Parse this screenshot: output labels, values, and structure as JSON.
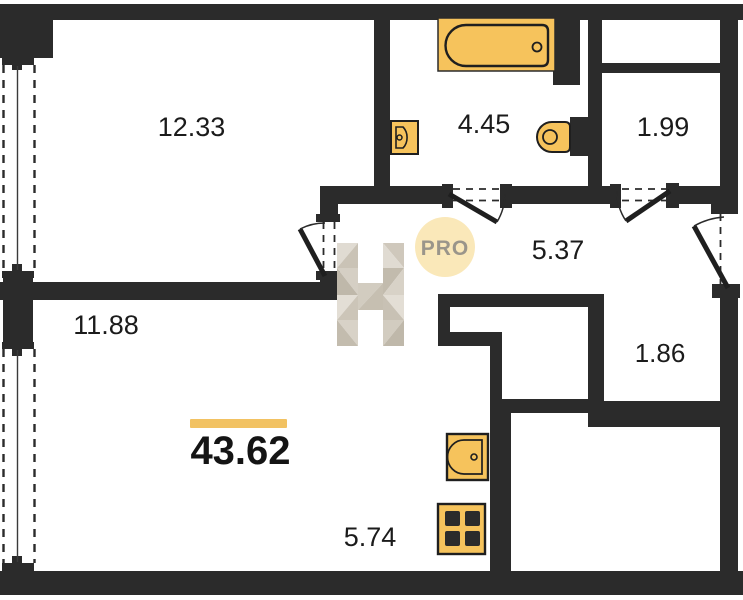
{
  "floorplan": {
    "total_area": "43.62",
    "rooms": [
      {
        "area": "12.33"
      },
      {
        "area": "4.45"
      },
      {
        "area": "1.99"
      },
      {
        "area": "5.37"
      },
      {
        "area": "1.86"
      },
      {
        "area": "11.88"
      },
      {
        "area": "5.74"
      }
    ],
    "watermark": {
      "pro": "PRO",
      "letter": "H"
    },
    "fixtures": [
      "bathtub-icon",
      "bath-sink-icon",
      "toilet-icon",
      "kitchen-sink-icon",
      "stove-icon"
    ],
    "colors": {
      "wall": "#2b2b2b",
      "fixture_fill": "#f6c35c",
      "fixture_outline": "#1f1f1f",
      "accent_bar": "#f2c262",
      "pro_circle": "#fae8b9",
      "pro_text": "#9a958a",
      "label_text": "#1b1b1b",
      "watermark_beige_light": "#e0dbd2",
      "watermark_beige_dark": "#bfb8aa"
    }
  }
}
